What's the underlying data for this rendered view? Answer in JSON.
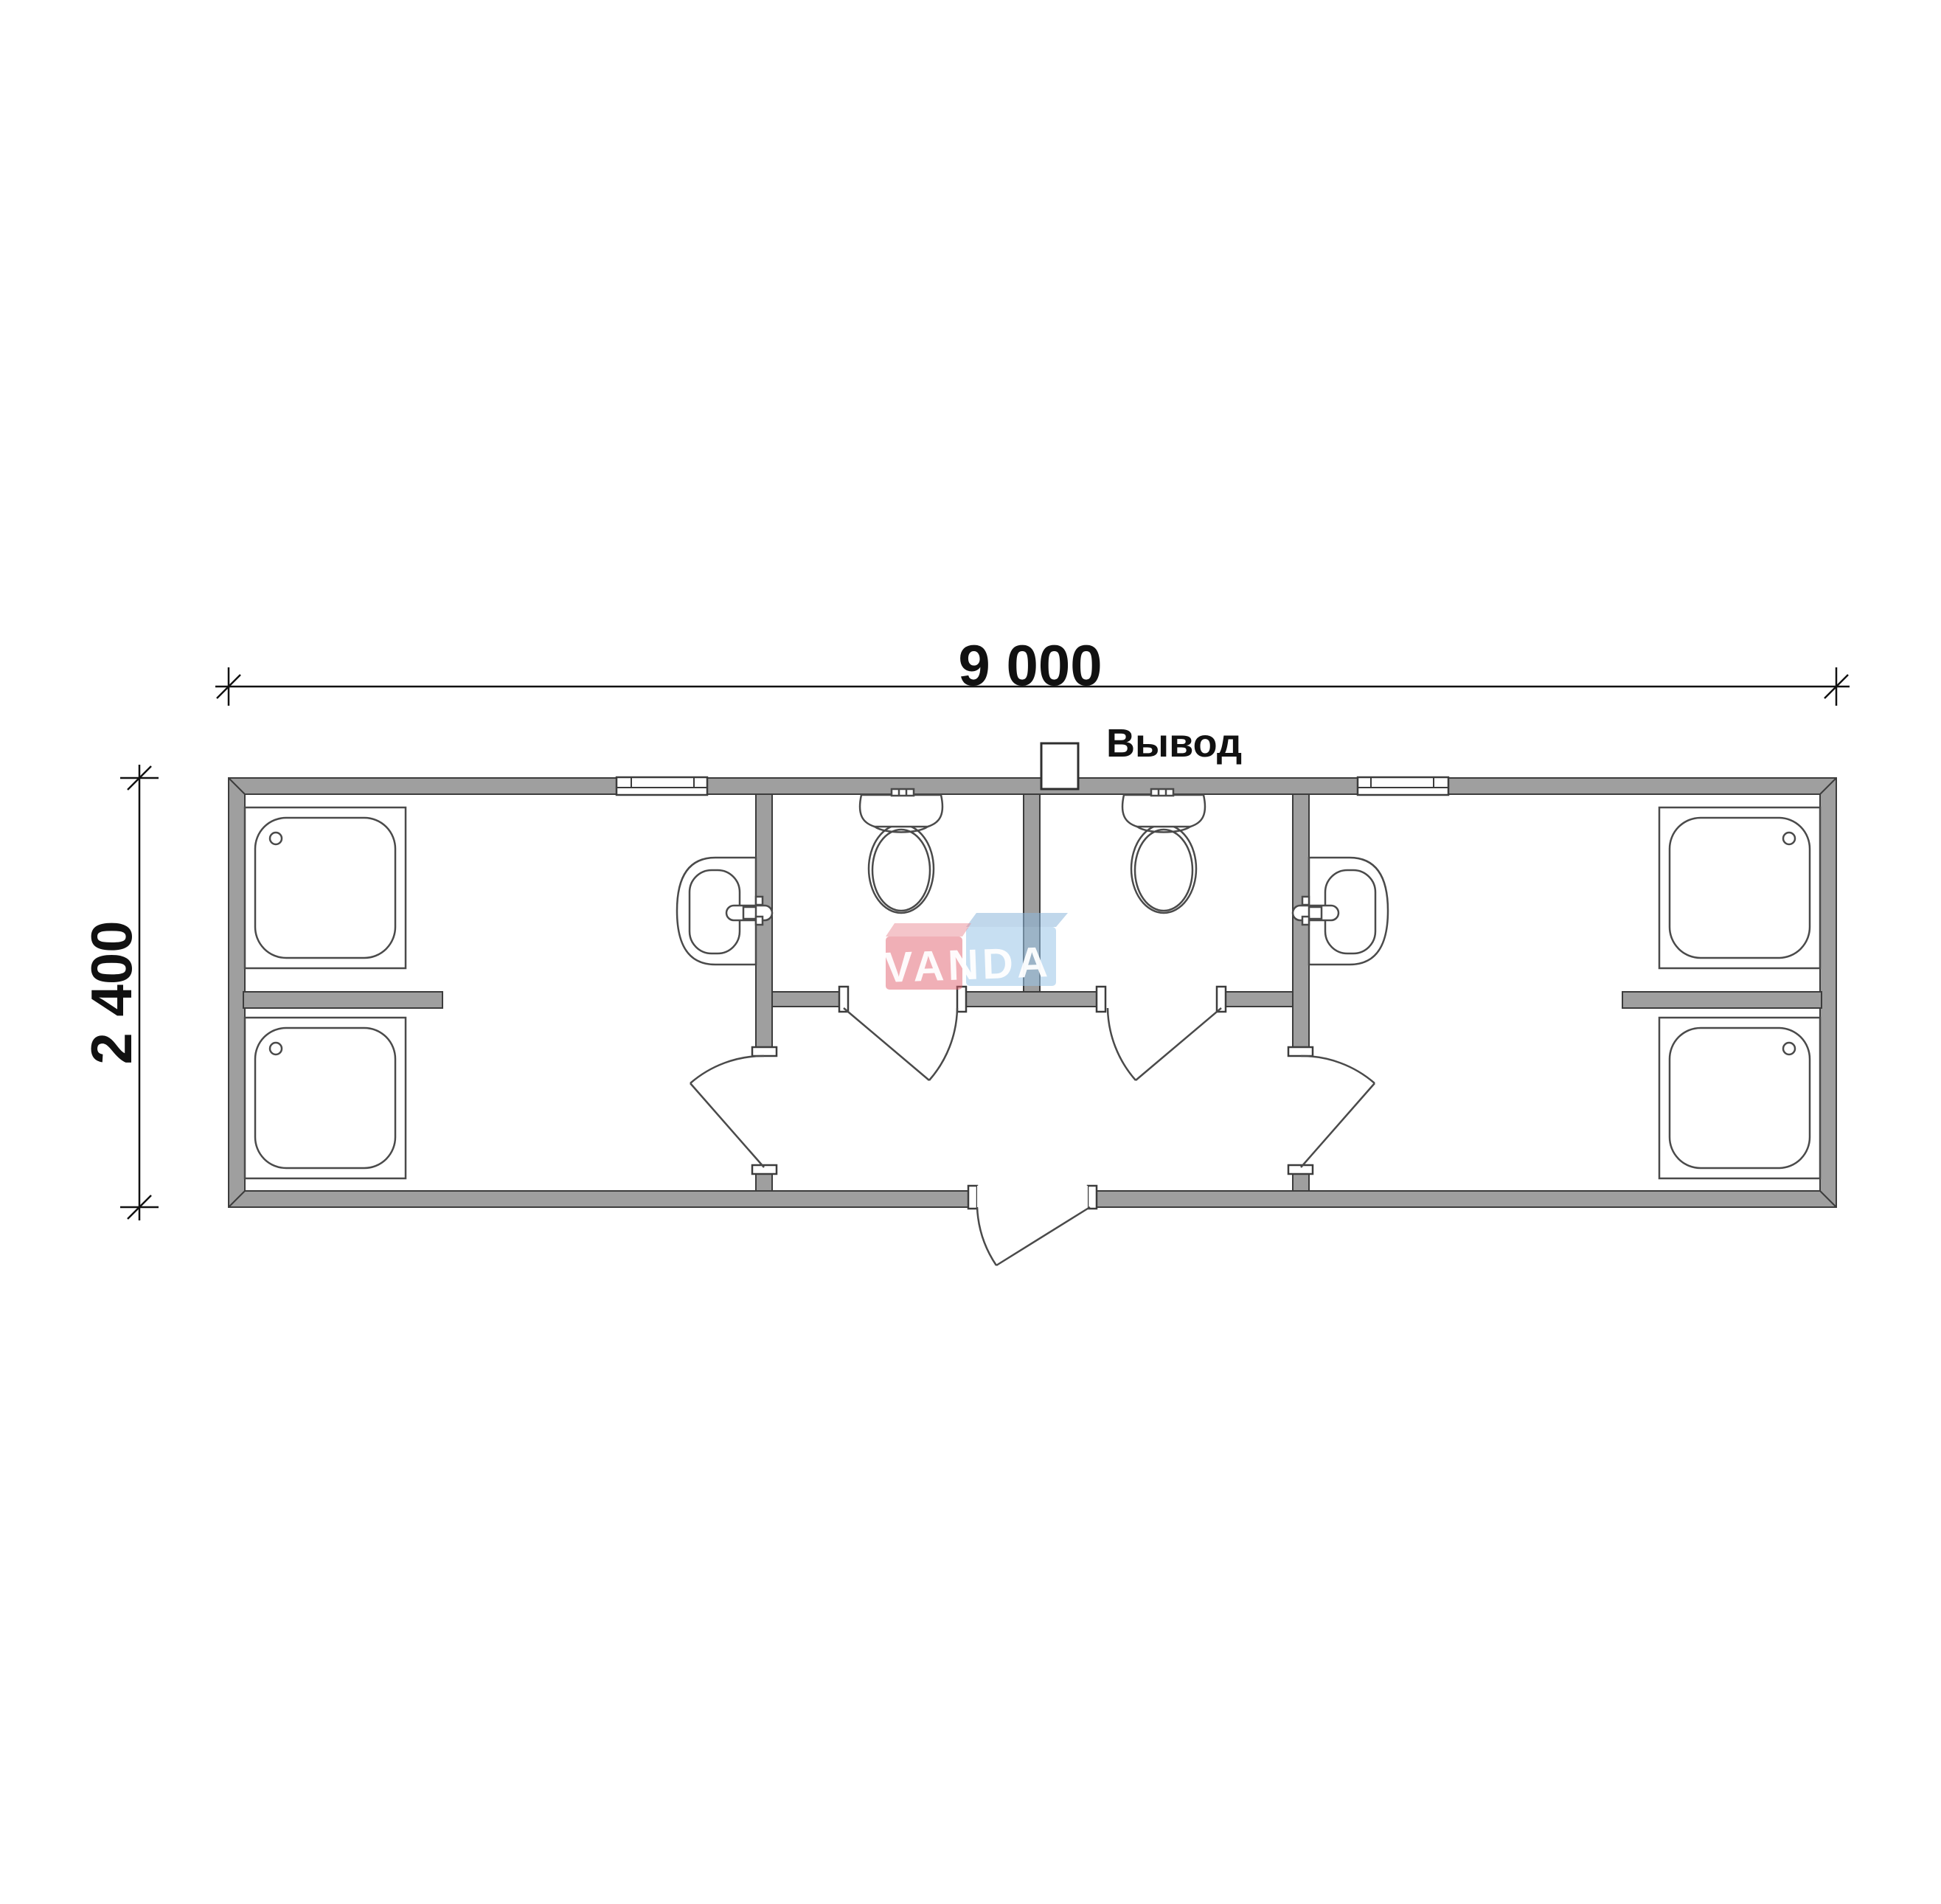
{
  "title": "Sanitary block floor plan 9000 x 2400",
  "labels": {
    "width_dimension": "9 000",
    "height_dimension": "2 400",
    "outlet": "Вывод"
  },
  "watermark": {
    "text": "VANDA"
  },
  "plan": {
    "overall_width_mm": 9000,
    "overall_depth_mm": 2400,
    "fixture_counts": {
      "shower_trays": 4,
      "toilets": 2,
      "wash_basins": 2,
      "interior_doors": 4,
      "entrance_doors": 1,
      "windows": 2,
      "service_outlets": 1
    }
  },
  "colors": {
    "background": "#ffffff",
    "wall-fill": "#9f9f9f",
    "wall-stroke": "#3c3c3c",
    "fixture-stroke": "#4a4a4a",
    "dim-color": "#111111",
    "logo-red": "#e2606e",
    "logo-red-top": "#e98b96",
    "logo-blue": "#99c4e8",
    "logo-blue-top": "#8cb6da",
    "logo-text": "#ffffff"
  }
}
